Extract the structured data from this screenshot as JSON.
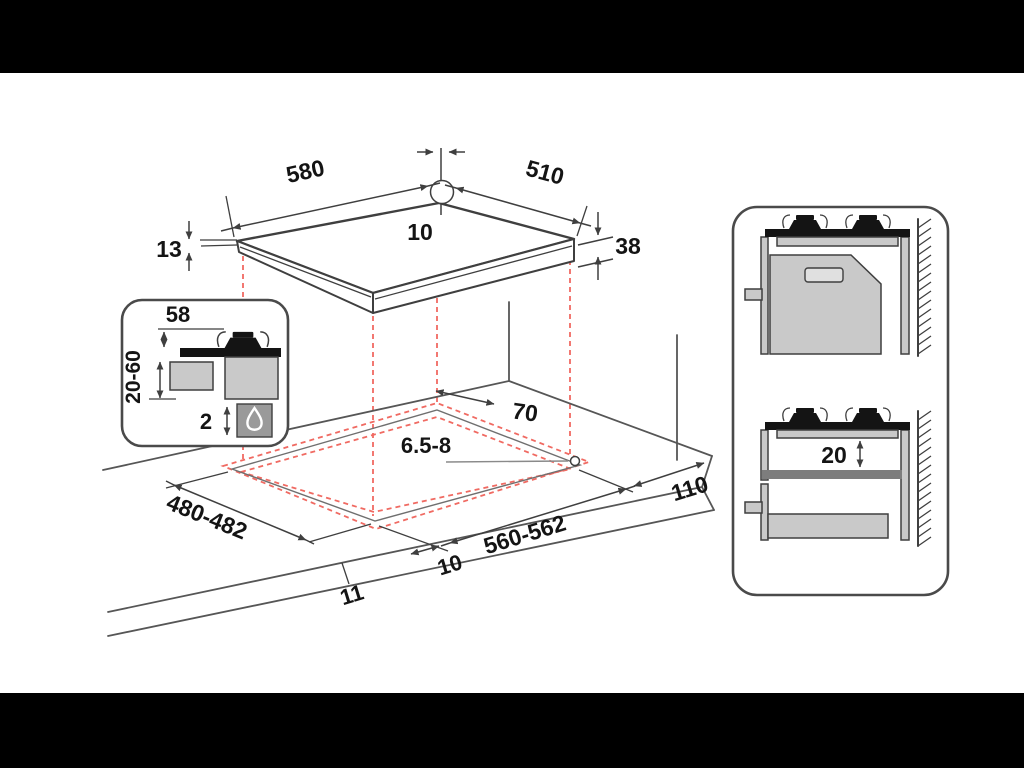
{
  "colors": {
    "line": "#3f3f3f",
    "accent_red": "#f06a62",
    "fill_light": "#c9c9c9",
    "fill_mid": "#9a9a9a",
    "fill_dark": "#7d7d7d",
    "ink": "#141414",
    "paper": "#ffffff",
    "letterbox": "#000000"
  },
  "hob_top_view": {
    "width": "580",
    "depth": "510",
    "hole_offset": "10",
    "rim_thickness": "13",
    "total_height": "38"
  },
  "burner_inset": {
    "height_above_worktop": "58",
    "worktop_thickness": "20-60",
    "bottom_clearance": "2"
  },
  "worktop_view": {
    "rear_clearance": "70",
    "hole_diameter": "6.5-8",
    "side_clearance": "110",
    "cutout_depth": "480-482",
    "cutout_width": "560-562",
    "front_offset": "10",
    "front_edge_offset": "11"
  },
  "wall_side_view": {
    "gap_below_hob": "20"
  }
}
